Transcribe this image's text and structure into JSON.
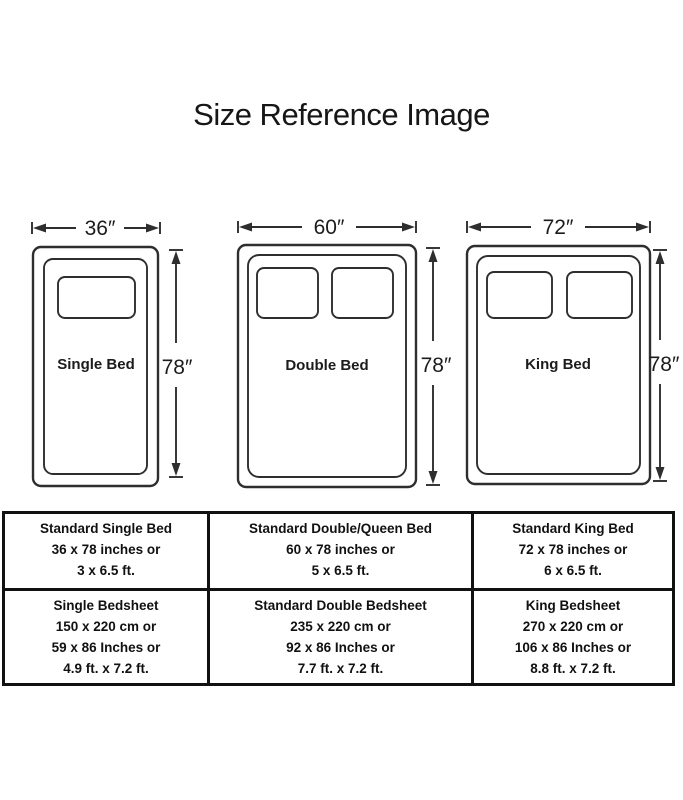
{
  "title": "Size Reference Image",
  "diagrams": [
    {
      "name": "Single Bed",
      "width_label": "36″",
      "height_label": "78″",
      "pillows": 1
    },
    {
      "name": "Double Bed",
      "width_label": "60″",
      "height_label": "78″",
      "pillows": 2
    },
    {
      "name": "King Bed",
      "width_label": "72″",
      "height_label": "78″",
      "pillows": 2
    }
  ],
  "table": {
    "rows": [
      [
        [
          "Standard Single Bed",
          "36 x 78 inches or",
          "3 x 6.5 ft."
        ],
        [
          "Standard Double/Queen Bed",
          "60 x 78 inches or",
          "5 x 6.5 ft."
        ],
        [
          "Standard King Bed",
          "72 x 78 inches or",
          "6 x 6.5 ft."
        ]
      ],
      [
        [
          "Single Bedsheet",
          "150 x 220 cm or",
          "59 x 86 Inches or",
          "4.9 ft. x 7.2 ft."
        ],
        [
          "Standard Double Bedsheet",
          "235 x 220 cm or",
          "92 x 86 Inches or",
          "7.7 ft. x 7.2 ft."
        ],
        [
          "King Bedsheet",
          "270 x 220 cm or",
          "106 x 86 Inches or",
          "8.8 ft. x 7.2 ft."
        ]
      ]
    ]
  }
}
